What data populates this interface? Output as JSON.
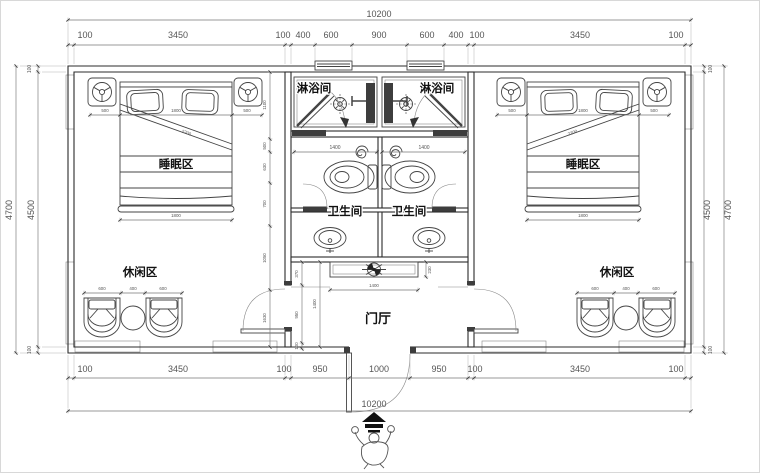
{
  "drawing": {
    "rooms": {
      "shower": "淋浴间",
      "toilet": "卫生间",
      "sleeping": "睡眠区",
      "leisure": "休闲区",
      "foyer": "门厅"
    },
    "dims": {
      "total": "10200",
      "top_chain": [
        "100",
        "3450",
        "100",
        "400",
        "600",
        "900",
        "600",
        "400",
        "100",
        "3450",
        "100"
      ],
      "bottom_chain": [
        "100",
        "3450",
        "100",
        "950",
        "1000",
        "950",
        "100",
        "3450",
        "100"
      ],
      "side_outer": "4700",
      "side_inner": "4500",
      "wall": "100",
      "shower_width": "1400",
      "bed_side": "500",
      "bed_width": "1800",
      "bed_length": "2200",
      "seat": "600",
      "seat_gap": "400",
      "cabinet_width": "1400",
      "cabinet_depth": "230",
      "foyer_depth": "1400",
      "foyer_chain": [
        "370",
        "950",
        "100"
      ],
      "room_chain": [
        "1100",
        "500",
        "630",
        "700",
        "1050",
        "1630"
      ]
    }
  }
}
